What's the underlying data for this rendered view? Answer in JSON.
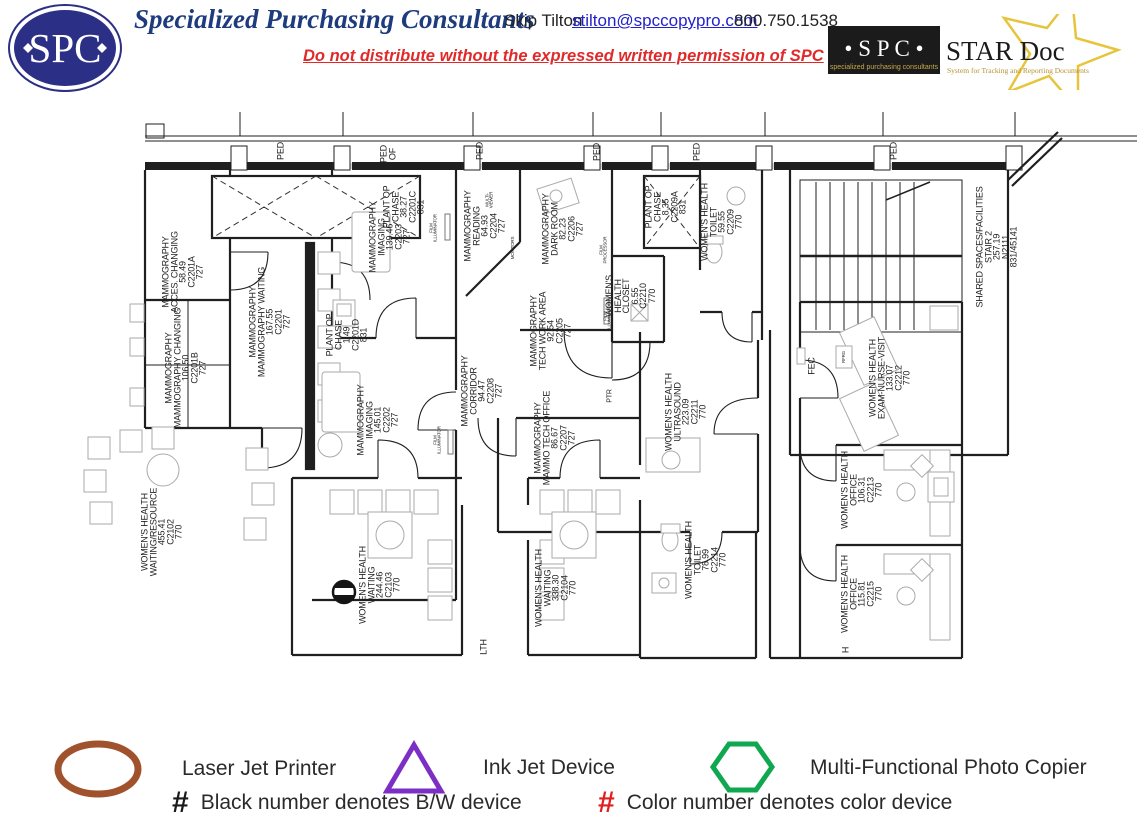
{
  "header": {
    "logo_text": "SPC",
    "company": "Specialized Purchasing Consultants",
    "contact_name": "Skip Tilton",
    "email": "stilton@spccopypro.com",
    "phone": "800.750.1538",
    "warning": "Do not distribute without the expressed written permission of SPC",
    "stardoc": {
      "spc": "• S P C •",
      "spc_tagline": "specialized purchasing consultants",
      "title": "STAR Doc",
      "tagline": "System for Tracking and Reporting Documents",
      "star_color": "#e6c53c"
    }
  },
  "floorplan": {
    "rooms": [
      {
        "lines": [
          "MAMMOGRAPHY",
          "ACCES. CHANGING",
          "58.49",
          "C2201A",
          "727"
        ],
        "x": 183,
        "y": 272
      },
      {
        "lines": [
          "PLANT OP",
          "CHASE",
          "38.27",
          "C2201C",
          "831"
        ],
        "x": 404,
        "y": 207
      },
      {
        "lines": [
          "MAMMOGRAPHY",
          "MAMMOGRAPHY  WAITING",
          "167.55",
          "C2201",
          "727"
        ],
        "x": 270,
        "y": 322
      },
      {
        "lines": [
          "MAMMOGRAPHY",
          "MAMMOGRAPHY  CHANGING",
          "106.50",
          "C2201B",
          "727"
        ],
        "x": 186,
        "y": 368
      },
      {
        "lines": [
          "MAMMOGRAPHY",
          "IMAGING",
          "139.46",
          "C2203",
          "727"
        ],
        "x": 390,
        "y": 237
      },
      {
        "lines": [
          "MAMMOGRAPHY",
          "READING",
          "64.93",
          "C2204",
          "727"
        ],
        "x": 485,
        "y": 226
      },
      {
        "lines": [
          "MAMMOGRAPHY",
          "DARK ROOM",
          "82.23",
          "C2206",
          "727"
        ],
        "x": 563,
        "y": 229
      },
      {
        "lines": [
          "MAMMOGRAPHY",
          "TECH WORK AREA",
          "92.54",
          "C2205",
          "727"
        ],
        "x": 551,
        "y": 331
      },
      {
        "lines": [
          "MAMMOGRAPHY",
          "CORRIDOR",
          "94.47",
          "C2208",
          "727"
        ],
        "x": 482,
        "y": 391
      },
      {
        "lines": [
          "MAMMOGRAPHY",
          "IMAGING",
          "145.01",
          "C2202",
          "727"
        ],
        "x": 378,
        "y": 420
      },
      {
        "lines": [
          "PLANT OP",
          "CHASE",
          "1.49",
          "C2201D",
          "831"
        ],
        "x": 347,
        "y": 335
      },
      {
        "lines": [
          "MAMMOGRAPHY",
          "MAMMO TECH OFFICE",
          "86.67",
          "C2207",
          "727"
        ],
        "x": 555,
        "y": 438
      },
      {
        "lines": [
          "PLANT OP",
          "CHASE",
          "8.35",
          "C2209A",
          "831"
        ],
        "x": 666,
        "y": 207
      },
      {
        "lines": [
          "WOMEN'S  HEALTH",
          "TOILET",
          "59.55",
          "C2209",
          "770"
        ],
        "x": 722,
        "y": 222
      },
      {
        "lines": [
          "WOMEN'S",
          "HEALTH",
          "CLOSET",
          "6.55",
          "C2210",
          "770"
        ],
        "x": 631,
        "y": 296
      },
      {
        "lines": [
          "WOMEN'S  HEALTH",
          "ULTRASOUND",
          "223.09",
          "C2211",
          "770"
        ],
        "x": 686,
        "y": 412
      },
      {
        "lines": [
          "WOMEN'S  HEALTH",
          "TOILET",
          "78.99",
          "C2214",
          "770"
        ],
        "x": 706,
        "y": 560
      },
      {
        "lines": [
          "WOMEN'S  HEALTH",
          "WAITING/RESOURCE",
          "455.41",
          "C2102",
          "770"
        ],
        "x": 162,
        "y": 532
      },
      {
        "lines": [
          "WOMEN'S  HEALTH",
          "WAITING",
          "244.46",
          "C2103",
          "770"
        ],
        "x": 380,
        "y": 585
      },
      {
        "lines": [
          "WOMEN'S  HEALTH",
          "WAITING",
          "338.30",
          "C2104",
          "770"
        ],
        "x": 556,
        "y": 588
      },
      {
        "lines": [
          "WOMEN'S  HEALTH",
          "EXAM-NURSE-VISIT",
          "133.07",
          "C2212",
          "770"
        ],
        "x": 890,
        "y": 378
      },
      {
        "lines": [
          "WOMEN'S  HEALTH",
          "OFFICE",
          "106.31",
          "C2213",
          "770"
        ],
        "x": 862,
        "y": 490
      },
      {
        "lines": [
          "WOMEN'S  HEALTH",
          "OFFICE",
          "115.81",
          "C2215",
          "770"
        ],
        "x": 862,
        "y": 594
      },
      {
        "lines": [
          "SHARED  SPACES/FACILITIES",
          "STAIR 2",
          "257.19",
          "N2111",
          "831/45141"
        ],
        "x": 997,
        "y": 247
      }
    ],
    "small_labels": [
      {
        "lines": [
          "PED"
        ],
        "x": 281,
        "y": 151,
        "size": 9
      },
      {
        "lines": [
          "PED",
          "OF"
        ],
        "x": 388,
        "y": 154,
        "size": 9
      },
      {
        "lines": [
          "PED"
        ],
        "x": 480,
        "y": 151,
        "size": 9
      },
      {
        "lines": [
          "PED"
        ],
        "x": 597,
        "y": 152,
        "size": 9
      },
      {
        "lines": [
          "PED"
        ],
        "x": 697,
        "y": 152,
        "size": 9
      },
      {
        "lines": [
          "PED"
        ],
        "x": 894,
        "y": 151,
        "size": 9
      },
      {
        "lines": [
          "FEC"
        ],
        "x": 812,
        "y": 366,
        "size": 9
      },
      {
        "lines": [
          "PTR"
        ],
        "x": 611,
        "y": 396,
        "size": 7
      },
      {
        "lines": [
          "RFRG"
        ],
        "x": 844,
        "y": 357,
        "size": 4.5
      },
      {
        "lines": [
          "LTH"
        ],
        "x": 484,
        "y": 647,
        "size": 9
      },
      {
        "lines": [
          "H"
        ],
        "x": 846,
        "y": 650,
        "size": 9
      },
      {
        "lines": [
          "FILM",
          "ILLUMINATOR"
        ],
        "x": 434,
        "y": 228,
        "size": 4.5
      },
      {
        "lines": [
          "FILM",
          "ILLUMINATOR"
        ],
        "x": 438,
        "y": 440,
        "size": 4.5
      },
      {
        "lines": [
          "FILM",
          "ILLUMINATOR"
        ],
        "x": 608,
        "y": 316,
        "size": 4.5
      },
      {
        "lines": [
          "FILM",
          "PROCESSOR"
        ],
        "x": 604,
        "y": 250,
        "size": 4.5
      },
      {
        "lines": [
          "MULTI-",
          "VIEWER"
        ],
        "x": 490,
        "y": 200,
        "size": 4.5
      },
      {
        "lines": [
          "MONITORS"
        ],
        "x": 513,
        "y": 248,
        "size": 4.5
      }
    ]
  },
  "legend": {
    "items": [
      {
        "shape": "ellipse",
        "color": "#a0522d",
        "label": "Laser Jet Printer"
      },
      {
        "shape": "triangle",
        "color": "#7b2fc4",
        "label": "Ink Jet Device"
      },
      {
        "shape": "hexagon",
        "color": "#0fa750",
        "label": "Multi-Functional Photo Copier"
      }
    ],
    "notes": [
      {
        "symbol": "#",
        "color": "#1a1a1a",
        "label": "Black number denotes B/W device"
      },
      {
        "symbol": "#",
        "color": "#e01f1f",
        "label": "Color number denotes color device"
      }
    ]
  }
}
